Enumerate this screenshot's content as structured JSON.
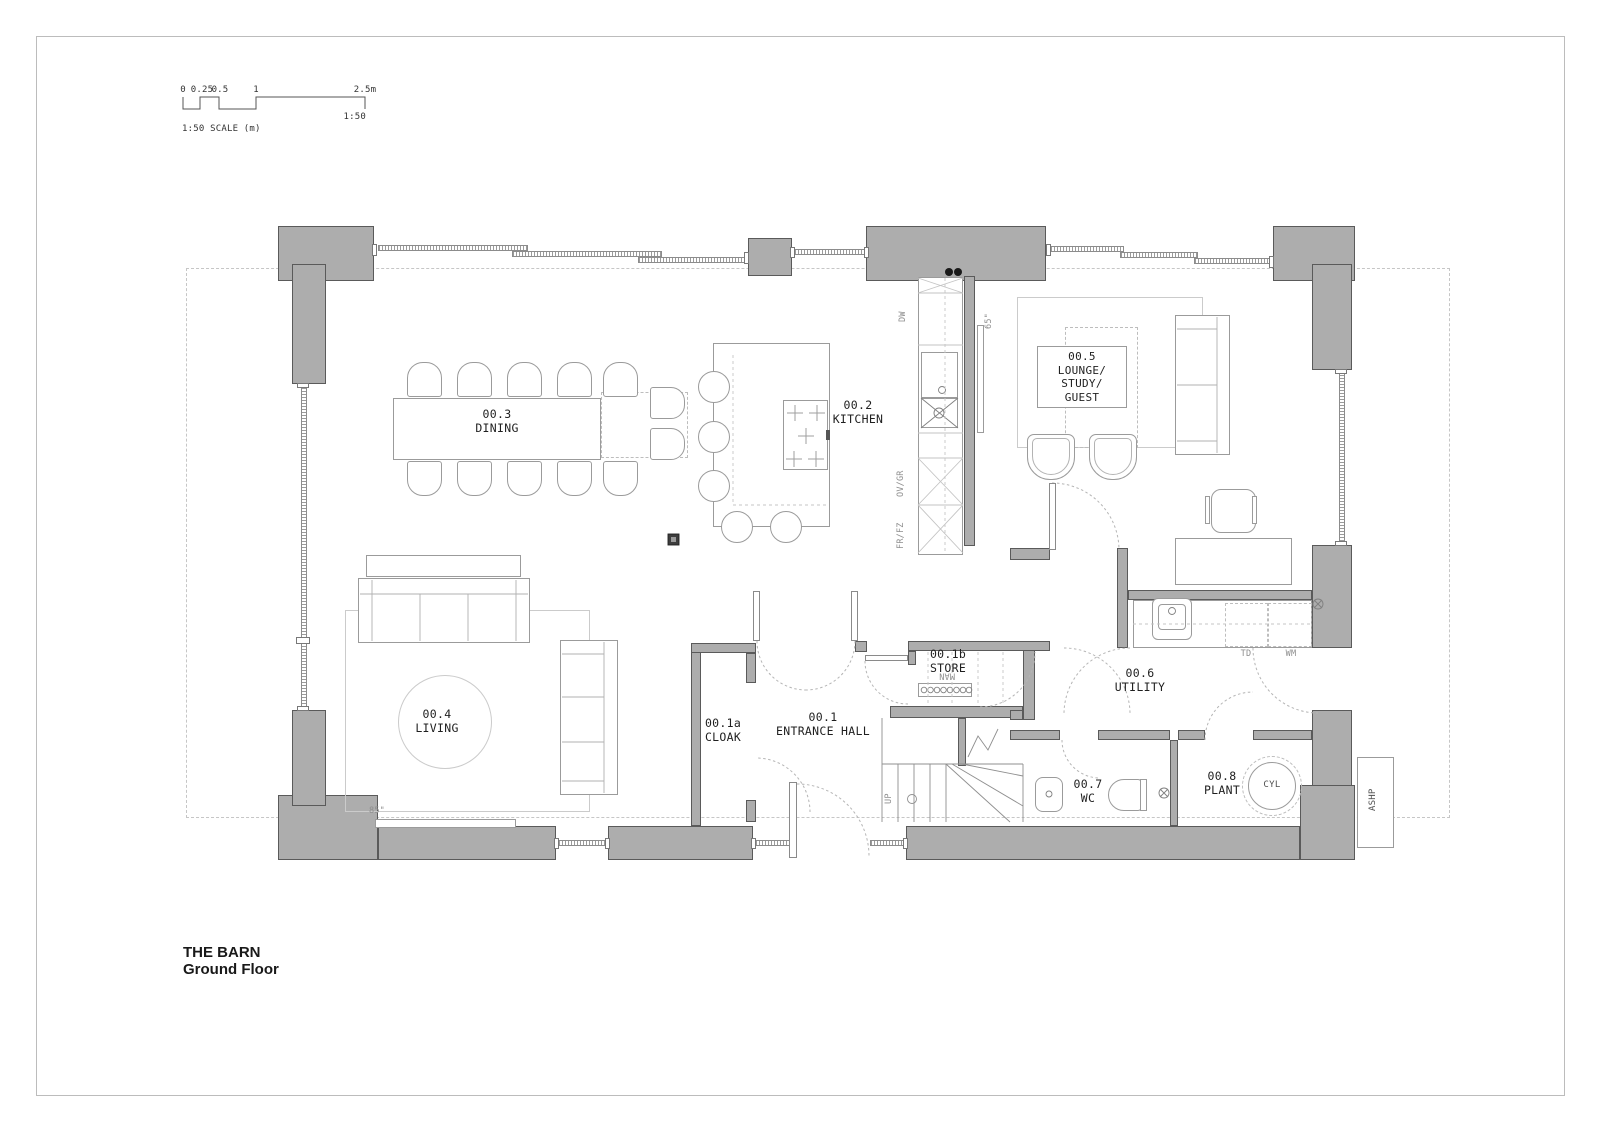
{
  "scale_bar": {
    "ticks": [
      "0",
      "0.25",
      "0.5",
      "1",
      "2.5m"
    ],
    "ratio_label": "1:50",
    "caption": "1:50 SCALE (m)"
  },
  "title_block": {
    "project": "THE BARN",
    "floor": "Ground Floor"
  },
  "rooms": {
    "dining": {
      "num": "00.3",
      "name": "DINING"
    },
    "kitchen": {
      "num": "00.2",
      "name": "KITCHEN"
    },
    "lounge": {
      "num": "00.5",
      "line1": "LOUNGE/",
      "line2": "STUDY/",
      "line3": "GUEST"
    },
    "living": {
      "num": "00.4",
      "name": "LIVING"
    },
    "cloak": {
      "num": "00.1a",
      "name": "CLOAK"
    },
    "hall": {
      "num": "00.1",
      "name": "ENTRANCE HALL"
    },
    "store": {
      "num": "00.1b",
      "name": "STORE"
    },
    "utility": {
      "num": "00.6",
      "name": "UTILITY"
    },
    "wc": {
      "num": "00.7",
      "name": "WC"
    },
    "plant": {
      "num": "00.8",
      "name": "PLANT"
    }
  },
  "appliances": {
    "dishwasher": "DW",
    "oven_grill": "OV/GR",
    "fridge_freezer": "FR/FZ",
    "manifold": "MAN",
    "tumble_dryer": "TD",
    "washing_machine": "WM",
    "cylinder": "CYL",
    "heat_pump": "ASHP"
  },
  "annotations": {
    "stairs_up": "UP",
    "tv_living": "85\"",
    "tv_kitchen": "65\""
  },
  "colors": {
    "wall_fill": "#adadad",
    "wall_outline": "#5a5a5a",
    "furniture_line": "#9b9b9b",
    "dashed_line": "#bdbdbd",
    "text_dark": "#1f1f1f",
    "text_grey": "#8e8e8e",
    "paper": "#ffffff"
  }
}
